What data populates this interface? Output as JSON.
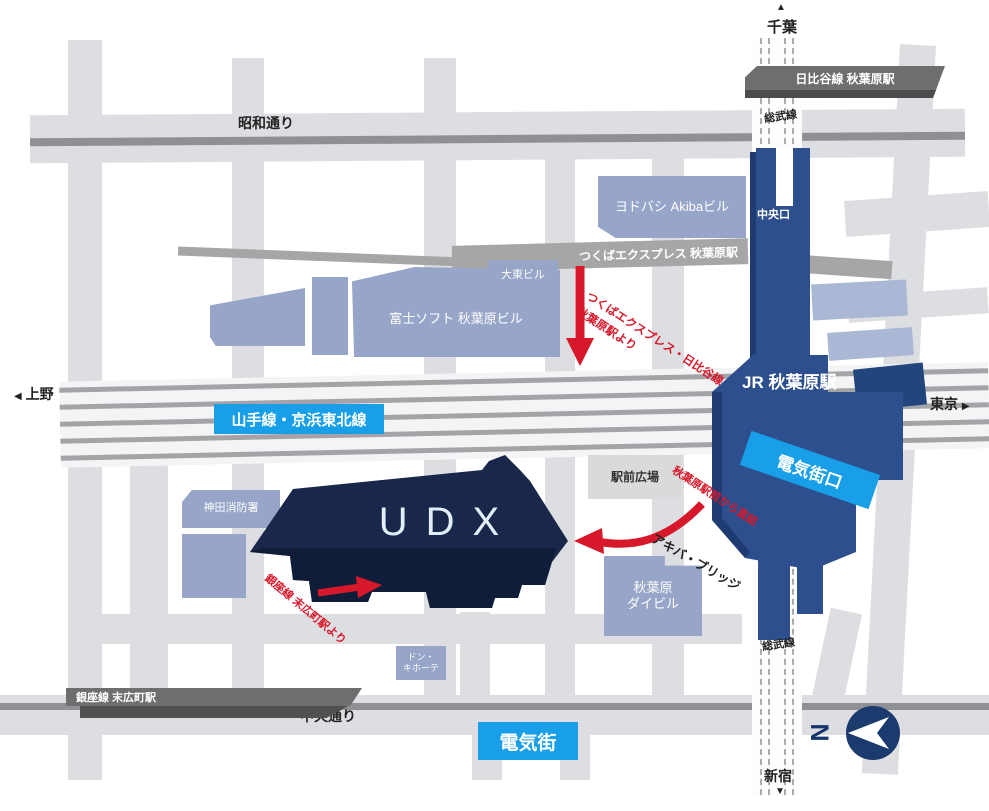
{
  "roads": {
    "showa_dori": "昭和通り",
    "chuo_dori": "中央通り"
  },
  "rail": {
    "hibiya_station": "日比谷線 秋葉原駅",
    "tx_station": "つくばエクスプレス 秋葉原駅",
    "ginza_station": "銀座線 末広町駅",
    "sobu_line_top": "総武線",
    "sobu_line_bottom": "総武線",
    "yamanote_keihin": "山手線・京浜東北線",
    "jr_station": "JR 秋葉原駅",
    "central_exit": "中央口",
    "electric_town_exit": "電気街口"
  },
  "areas": {
    "electric_town": "電気街",
    "ekimae_plaza": "駅前広場"
  },
  "buildings": {
    "udx": "UDX",
    "yodobashi": "ヨドバシ Akibaビル",
    "daito": "大東ビル",
    "fujisoft": "富士ソフト 秋葉原ビル",
    "kanda_fire": "神田消防署",
    "daibiru_line1": "秋葉原",
    "daibiru_line2": "ダイビル",
    "donki_line1": "ドン・",
    "donki_line2": "キホーテ"
  },
  "directions": {
    "chiba": "千葉",
    "shinjuku": "新宿",
    "ueno": "上野",
    "tokyo": "東京",
    "up_arrow": "▲",
    "down_arrow": "▼",
    "left_arrow": "◀",
    "right_arrow": "▶"
  },
  "routes": {
    "tx_access_line1": "つくばエクスプレス・日比谷線",
    "tx_access_line2": "秋葉原駅より",
    "direct_access": "秋葉原駅前から直結",
    "ginza_access": "銀座線 末広町駅より",
    "akiba_bridge": "アキバ・ブリッジ"
  },
  "compass": {
    "north": "N"
  },
  "colors": {
    "accent_blue": "#189fe8",
    "station_blue": "#2d4f8e",
    "udx_navy": "#19284a",
    "building_blue_gray": "#96a5c8",
    "route_red": "#d7182a"
  }
}
